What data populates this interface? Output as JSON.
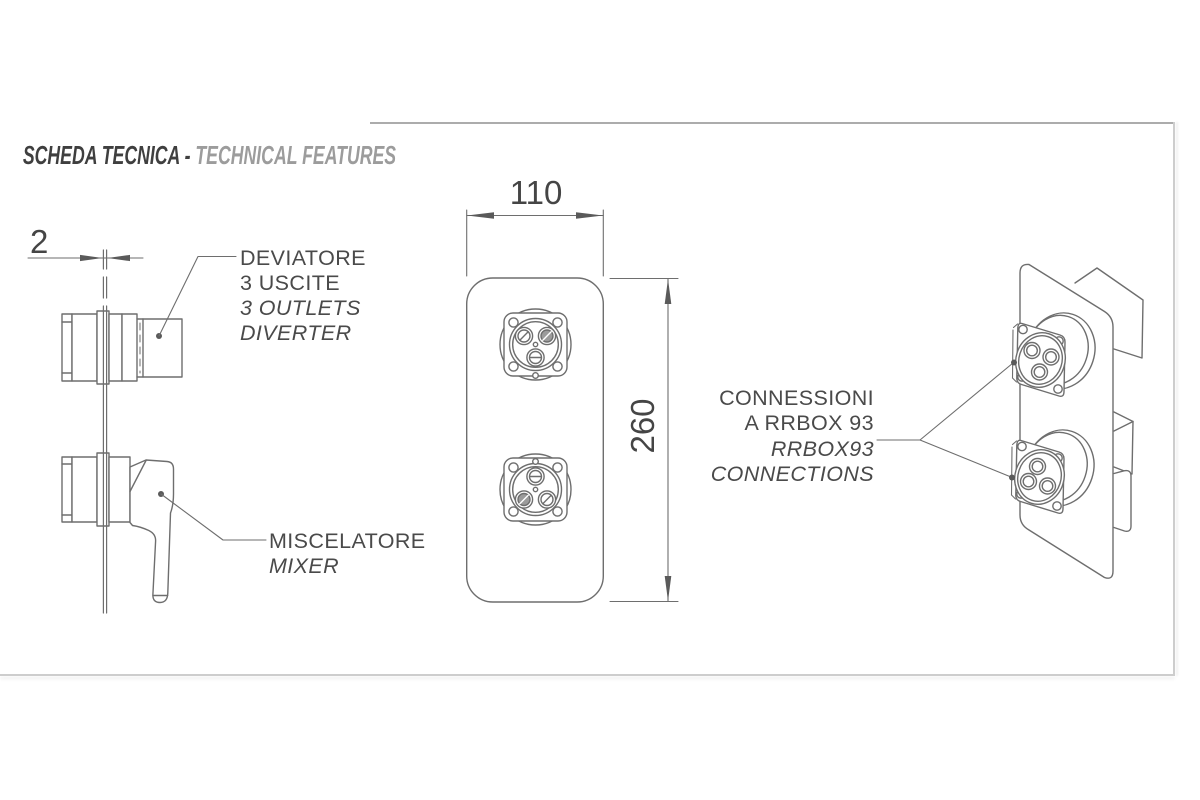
{
  "header": {
    "title_primary": "SCHEDA TECNICA - ",
    "title_secondary": "TECHNICAL FEATURES"
  },
  "drawing": {
    "line_color": "#6e6e6e",
    "accent_fill": "#5a5a5a",
    "text_color": "#4a4a4a",
    "side_view": {
      "thickness_dim": "2",
      "diverter_label": [
        "DEVIATORE",
        "3 USCITE",
        "3 OUTLETS",
        "DIVERTER"
      ],
      "mixer_label": [
        "MISCELATORE",
        "MIXER"
      ]
    },
    "front_view": {
      "width_dim": "110",
      "height_dim": "260"
    },
    "perspective_view": {
      "connections_label": [
        "CONNESSIONI",
        "A RRBOX 93",
        "RRBOX93",
        "CONNECTIONS"
      ]
    }
  }
}
